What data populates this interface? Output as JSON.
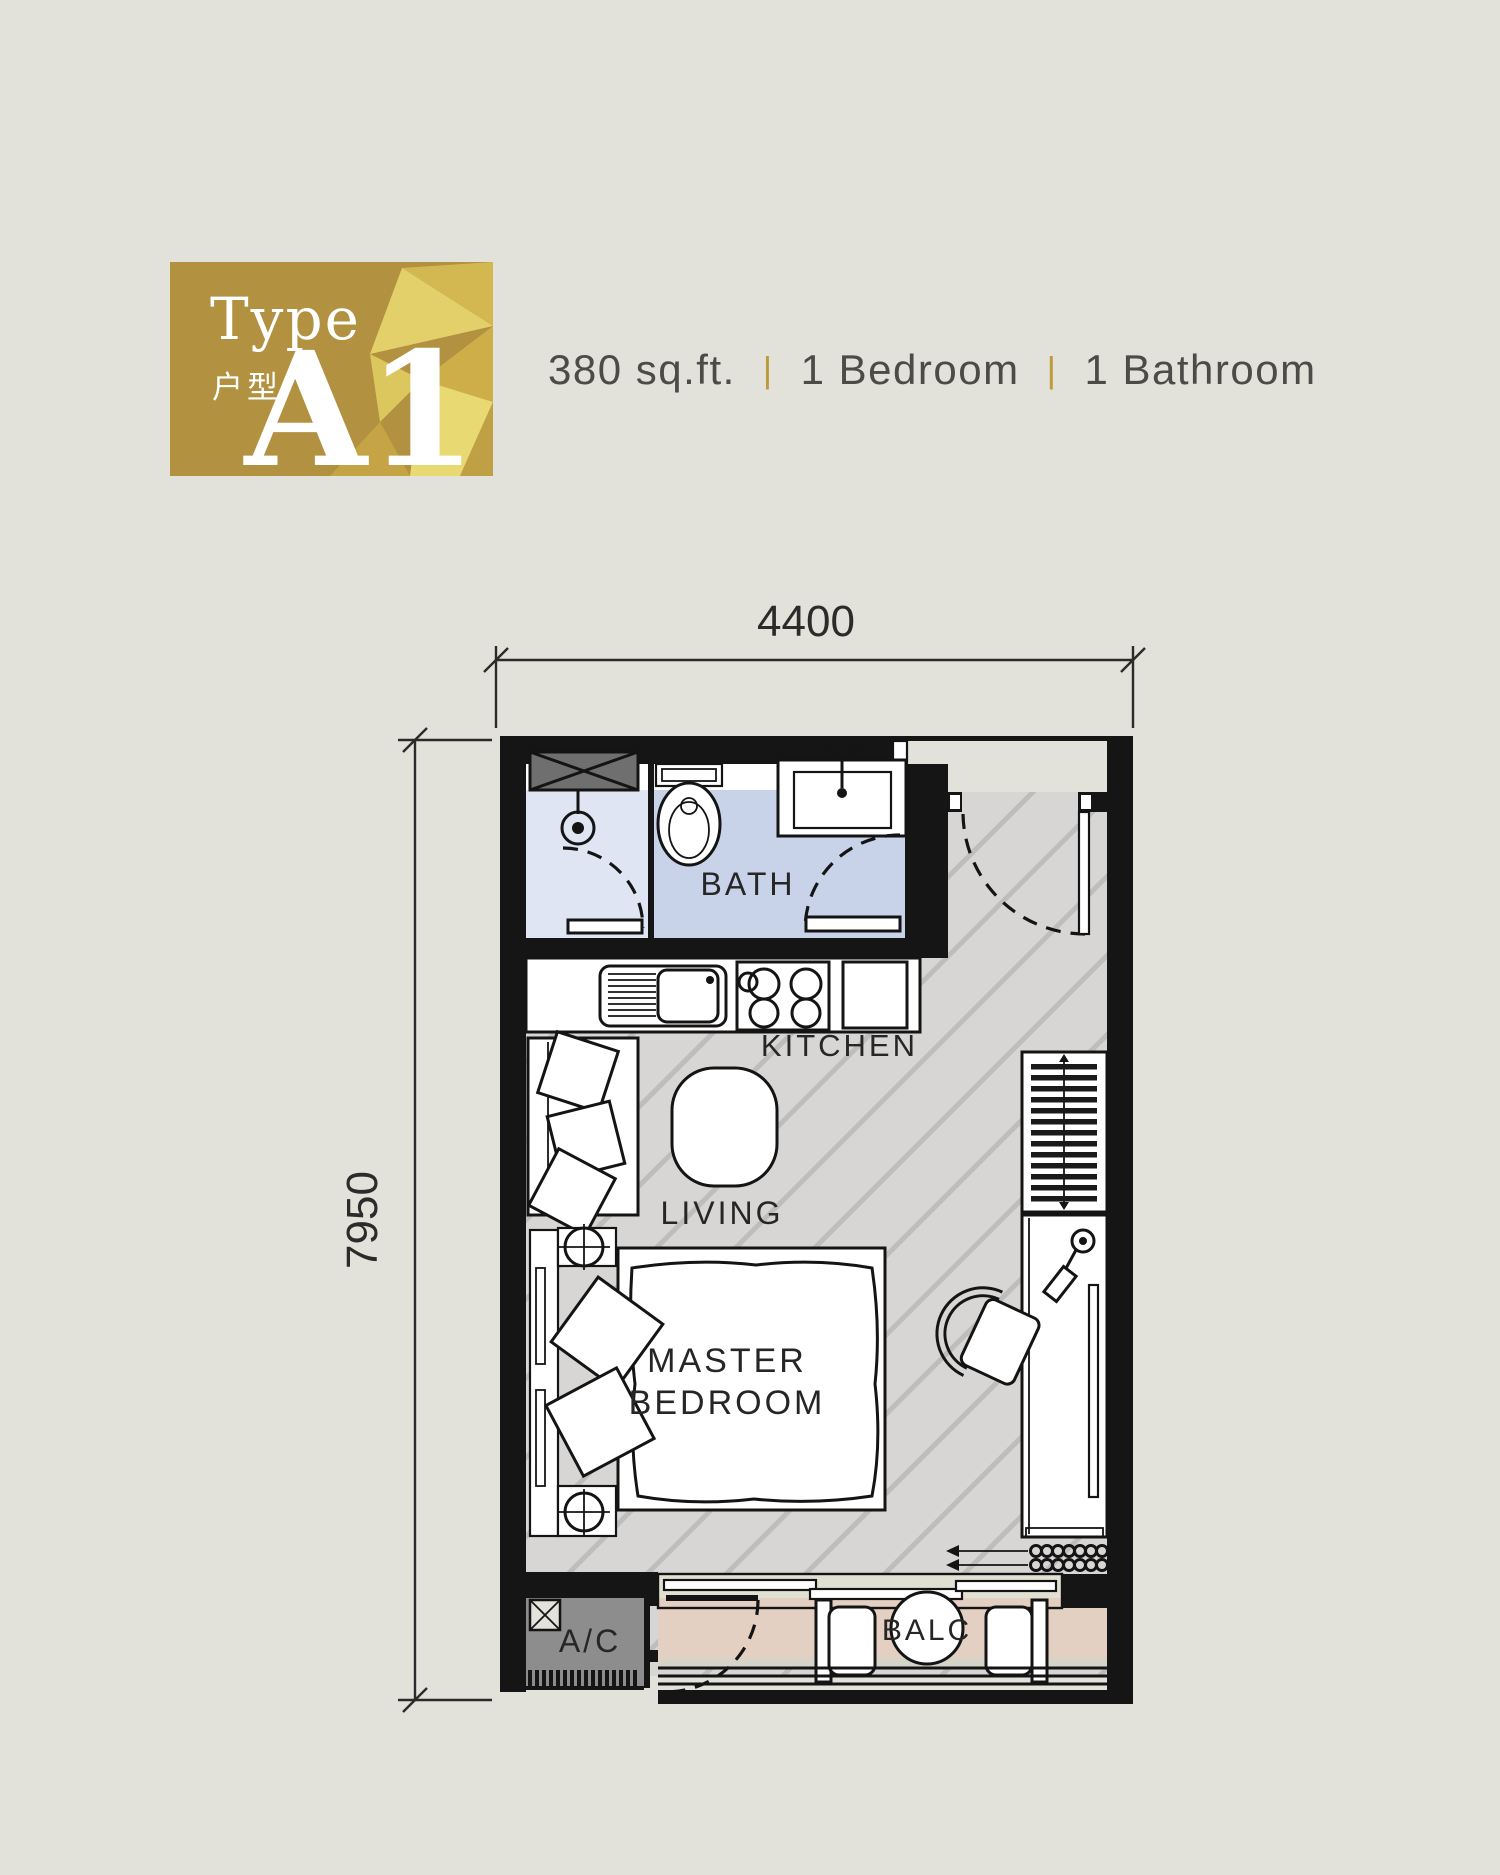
{
  "page": {
    "background_color": "#e2e2da"
  },
  "badge": {
    "type_label_en": "Type",
    "type_label_cn": "户型",
    "unit_code": "A1",
    "base_color": "#b29140",
    "facet_colors": [
      "#d3b851",
      "#e4d06a",
      "#cdae48",
      "#dcc75f",
      "#e8d973",
      "#c4a445",
      "#bfa044"
    ]
  },
  "header": {
    "area": "380 sq.ft.",
    "divider": "|",
    "bedrooms": "1 Bedroom",
    "bathrooms": "1 Bathroom",
    "text_color": "#4b4b47",
    "divider_color": "#bf9a3d"
  },
  "floorplan": {
    "dimensions": {
      "top_width": "4400",
      "left_height": "7950"
    },
    "labels": {
      "bath": "BATH",
      "kitchen": "KITCHEN",
      "living": "LIVING",
      "master_line1": "MASTER",
      "master_line2": "BEDROOM",
      "ac": "A/C",
      "balcony": "BALC"
    },
    "colors": {
      "wall": "#151515",
      "floor": "#d8d6d5",
      "floor_hatch": "#bfbdbc",
      "bath_floor": "#c8d2e9",
      "shower_floor": "#dfe5f3",
      "balcony_floor": "#e4cfc3",
      "ac_deck": "#8d8d8d",
      "shaft": "#6f6f6f",
      "dimension_text": "#2b2b2b"
    }
  }
}
